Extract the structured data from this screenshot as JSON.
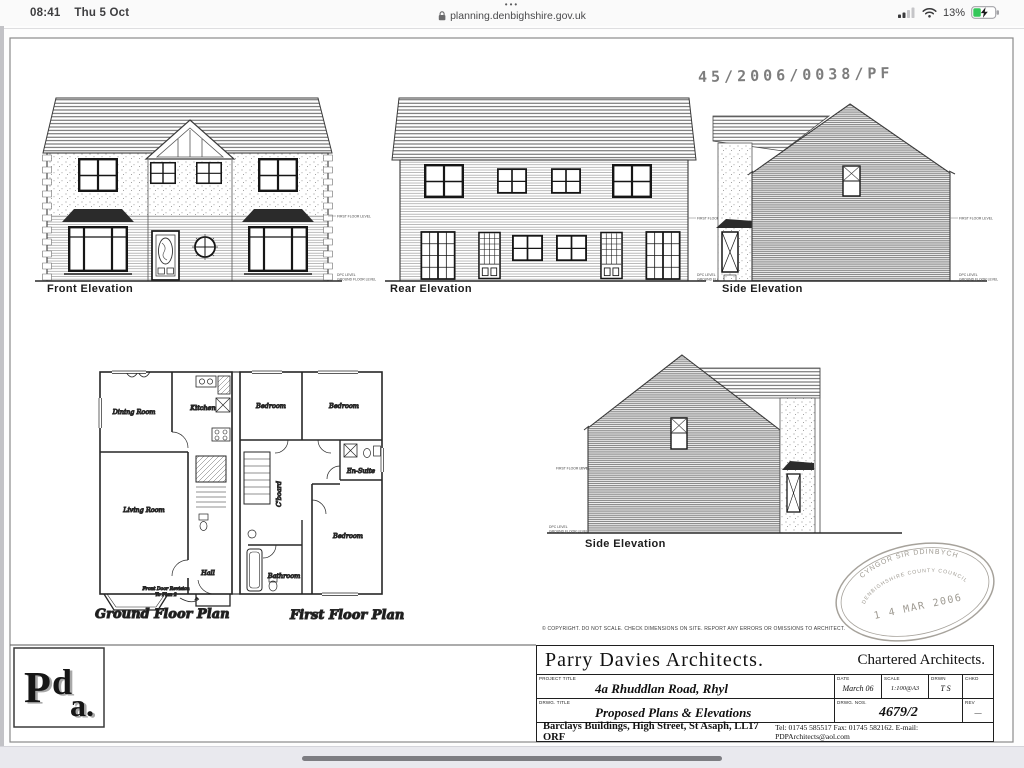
{
  "status_bar": {
    "time": "08:41",
    "date": "Thu 5 Oct",
    "dots": "•••",
    "url": "planning.denbighshire.gov.uk",
    "battery_percent": "13%"
  },
  "sheet": {
    "planning_ref": "45/2006/0038/PF",
    "copyright": "© COPYRIGHT. DO NOT SCALE. CHECK DIMENSIONS ON SITE. REPORT ANY ERRORS OR OMISSIONS TO ARCHITECT.",
    "elevations": {
      "front": "Front Elevation",
      "rear": "Rear Elevation",
      "side_upper": "Side Elevation",
      "side_lower": "Side Elevation"
    },
    "plans": {
      "ground": "Ground Floor Plan",
      "first": "First Floor Plan"
    },
    "rooms": {
      "dining": "Dining Room",
      "kitchen": "Kitchen",
      "living": "Living Room",
      "hall": "Hall",
      "bedroom": "Bedroom",
      "ensuite": "En-Suite",
      "bathroom": "Bathroom",
      "cupboard": "C'board"
    },
    "notes": {
      "front_door_line1": "Front Door Revision",
      "front_door_line2": "To Plan 2",
      "first_floor_level": "FIRST FLOOR LEVEL",
      "dpc_level": "DPC LEVEL",
      "ground_floor_level": "GROUND FLOOR LEVEL"
    },
    "received_stamp": {
      "line1": "CYNGOR SIR DDINBYCH",
      "line2": "DENBIGHSHIRE COUNTY COUNCIL",
      "date": "1 4 MAR 2006"
    },
    "title_block": {
      "firm": "Parry Davies Architects.",
      "chartered": "Chartered Architects.",
      "project_title_label": "PROJECT TITLE",
      "project_title": "4a Rhuddlan Road, Rhyl",
      "date_label": "DATE",
      "date": "March 06",
      "scale_label": "SCALE",
      "scale": "1:100@A3",
      "drawn_label": "DRWN",
      "drawn": "T S",
      "checked_label": "CHKD",
      "checked": "",
      "drwg_title_label": "DRWG. TITLE",
      "drwg_title": "Proposed Plans & Elevations",
      "drwg_no_label": "DRWG. NOS.",
      "drwg_no": "4679/2",
      "rev_label": "REV",
      "rev": "—",
      "address": "Barclays Buildings, High Street, St Asaph, LL17 ORF",
      "contact": "Tel: 01745 585517  Fax: 01745 582162.  E-mail: PDPArchitects@aol.com"
    },
    "logo": {
      "p": "P",
      "d": "d",
      "a": "a."
    }
  }
}
